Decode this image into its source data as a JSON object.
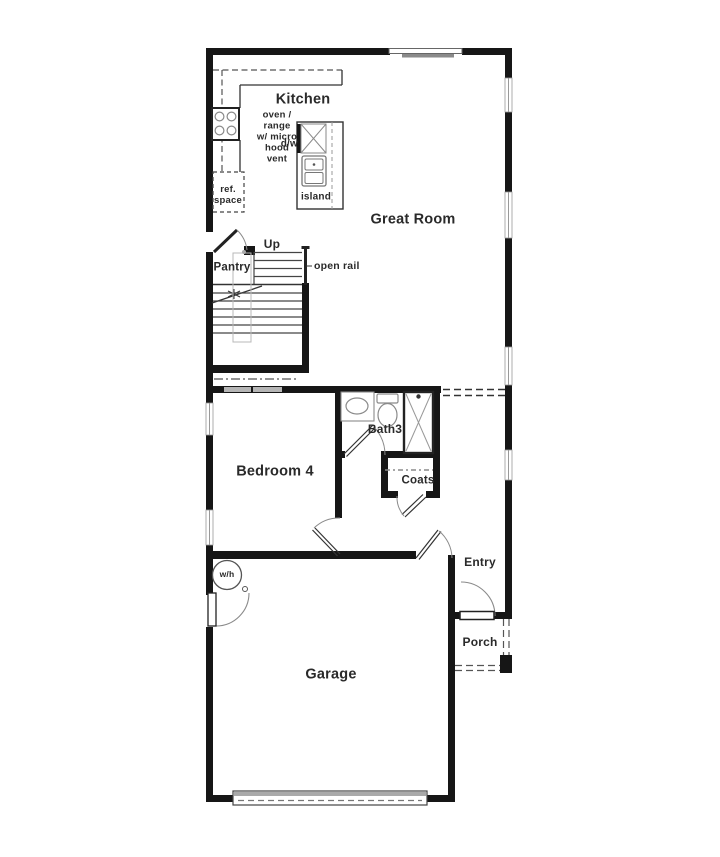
{
  "labels": {
    "kitchen": "Kitchen",
    "great_room": "Great Room",
    "oven_range_note": "oven /\nrange\nw/ micro\nhood\nvent",
    "dishwasher": "d/w",
    "island": "island",
    "ref_space": "ref.\nspace",
    "up": "Up",
    "open_rail": "open rail",
    "pantry": "Pantry",
    "bedroom4": "Bedroom 4",
    "bath3": "Bath3",
    "coats": "Coats",
    "entry": "Entry",
    "porch": "Porch",
    "garage": "Garage",
    "water_heater": "w/h"
  },
  "colors": {
    "wall": "#161616",
    "fixture": "#8a8a8a",
    "counter_dash": "#555555",
    "text": "#2a2a2a",
    "background": "#ffffff"
  }
}
